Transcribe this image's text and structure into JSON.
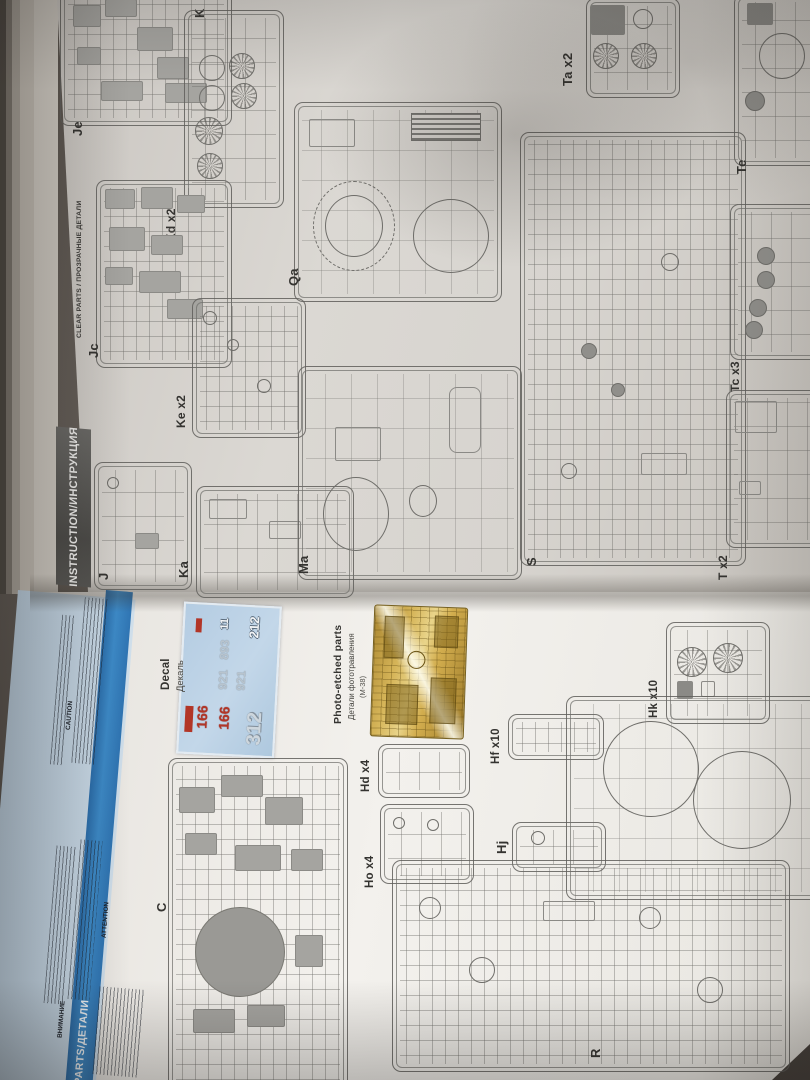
{
  "top_page": {
    "clear_parts_header": "CLEAR PARTS / ПРОЗРАЧНЫЕ ДЕТАЛИ",
    "instruction_banner": "INSTRUCTION/ИНСТРУКЦИЯ",
    "sprues": {
      "je": "Je",
      "k_partial": "K",
      "kd": "Kd x2",
      "jc": "Jc",
      "ke": "Ke x2",
      "j": "J",
      "ka": "Ka",
      "qa": "Qa",
      "ma": "Ma",
      "s": "S",
      "ta": "Ta x2",
      "te": "Te",
      "tc": "Tc x3",
      "t": "T x2"
    }
  },
  "bottom_page": {
    "parts_stripe": "PARTS/ДЕТАЛИ",
    "notes_headings": {
      "caution": "CAUTION",
      "attention": "ATTENTION",
      "vnimanie": "ВНИМАНИЕ"
    },
    "decal": {
      "label_en": "Decal",
      "label_ru": "Декаль",
      "numbers": [
        "212",
        "11",
        "893",
        "921",
        "921",
        "166",
        "166",
        "312"
      ]
    },
    "photo_etched": {
      "label_en": "Photo-etched parts",
      "label_ru": "Детали фототравления",
      "code": "(М-38)"
    },
    "sprues": {
      "c": "C",
      "hd": "Hd x4",
      "ho": "Ho x4",
      "hf": "Hf x10",
      "hj": "Hj",
      "hk": "Hk x10",
      "r": "R"
    }
  },
  "colors": {
    "accent_blue": "#2f7cbe",
    "panel_blue": "#c7d8e7",
    "decal_blue": "#b9cfe4",
    "decal_red": "#b23527",
    "pe_gold": "#d5b458",
    "desk": "#56504a"
  }
}
